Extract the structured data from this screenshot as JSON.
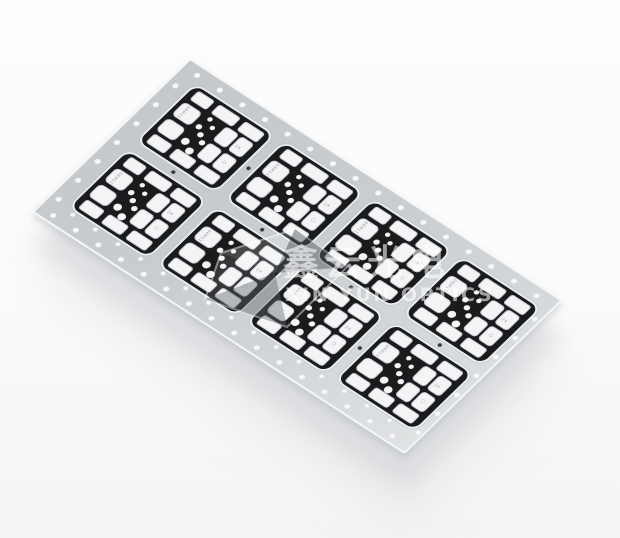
{
  "scene": {
    "type": "product-photo",
    "subject": "Panel of eight LED aluminum PCBs (black solder mask with white pads) on a light gray perforated carrier film, photographed at an angle on a white background",
    "background_color": "#fbfbfc"
  },
  "watermark": {
    "cn": "鑫云光电",
    "en": "XIN YUN OPTICS",
    "color": "rgba(255,255,255,0.58)"
  },
  "panel": {
    "color": "#cacdd0",
    "edge_highlight_color": "#f6f8f9",
    "hole_color": "#f7f8f9",
    "grid_rows": 2,
    "grid_cols": 4,
    "board_count": 8,
    "top_hole_count": 16,
    "bottom_outer_hole_count": 16,
    "bottom_inner_hole_count": 15,
    "side_hole_count": 7,
    "fiducial_count": 6
  },
  "board": {
    "mask_color": "#1a1b1d",
    "pad_color": "#f3f4f5",
    "markings": {
      "serial": "08M11",
      "qty": "2X",
      "logo_glyph": "◇"
    }
  }
}
